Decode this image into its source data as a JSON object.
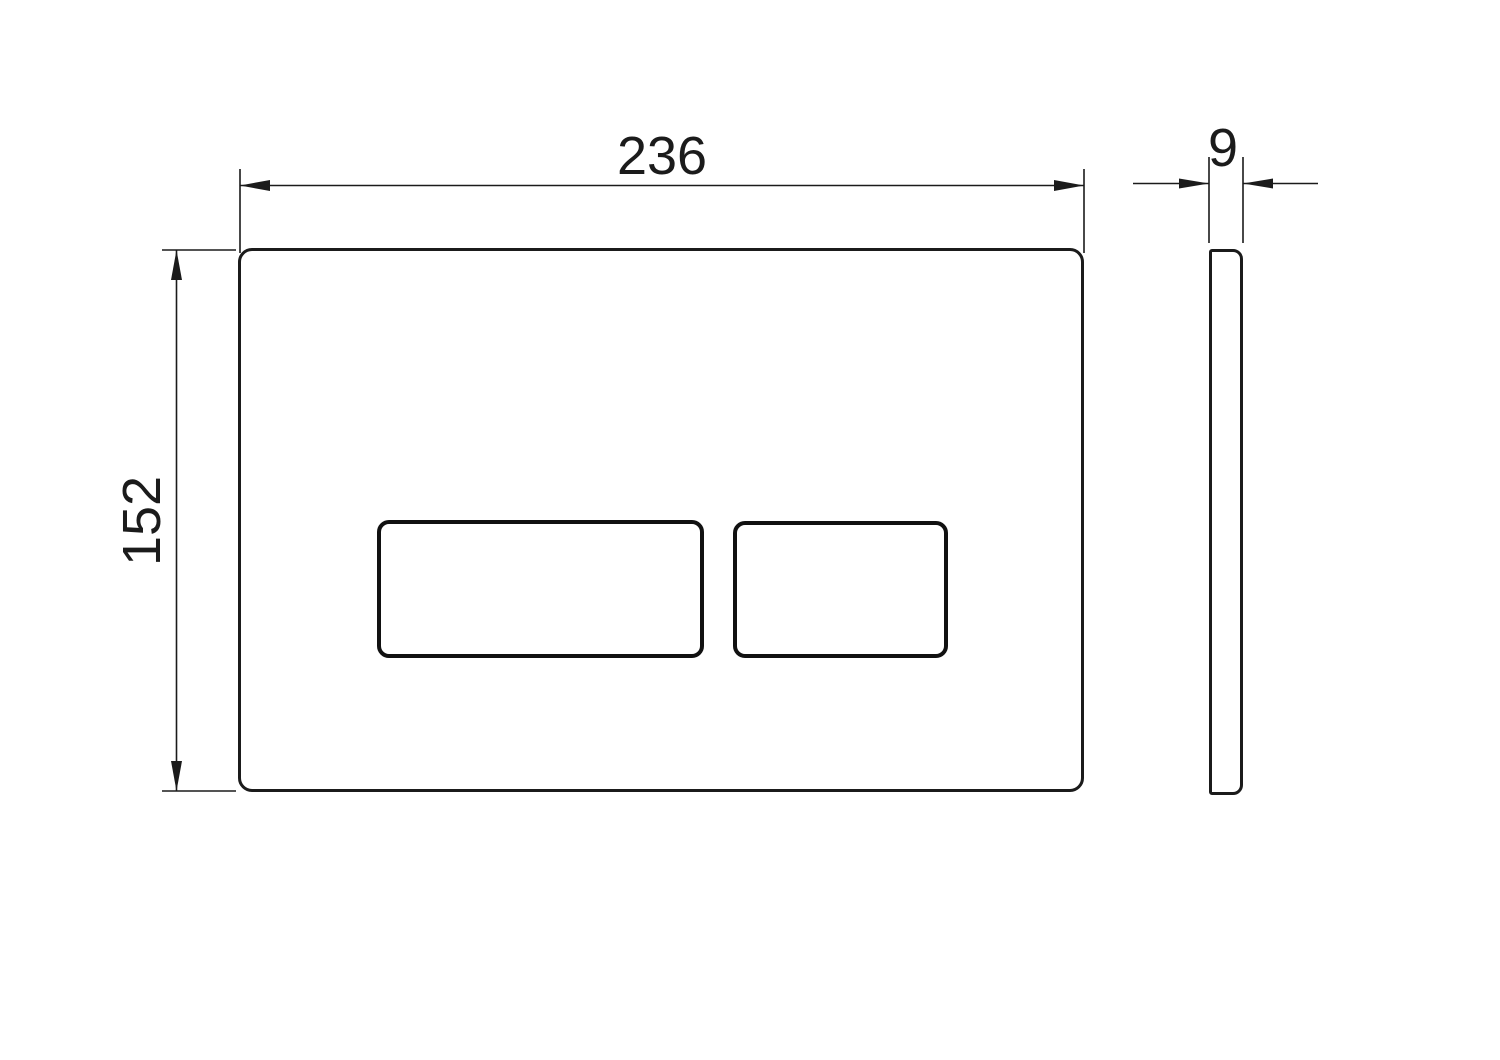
{
  "dimensions": {
    "width_label": "236",
    "height_label": "152",
    "thickness_label": "9"
  },
  "colors": {
    "background": "#ffffff",
    "line": "#1b1b1b"
  }
}
